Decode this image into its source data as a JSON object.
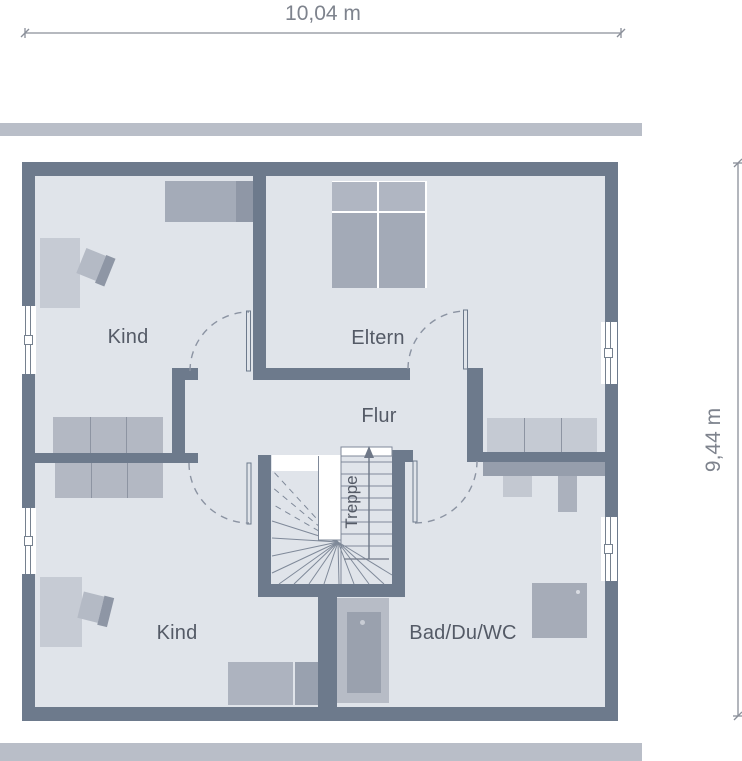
{
  "dimensions": {
    "width_label": "10,04 m",
    "height_label": "9,44 m"
  },
  "rooms": {
    "kind_top": {
      "label": "Kind"
    },
    "eltern": {
      "label": "Eltern"
    },
    "flur": {
      "label": "Flur"
    },
    "kind_bottom": {
      "label": "Kind"
    },
    "bad": {
      "label": "Bad/Du/WC"
    },
    "treppe": {
      "label": "Treppe"
    }
  },
  "colors": {
    "wall": "#6d7a8c",
    "floor": "#e0e4ea",
    "divider_bar": "#b9bec8",
    "room_label_text": "#545a66",
    "dimension_text": "#7e838d",
    "furniture_light": "#c6cbd4",
    "furniture_mid": "#b3b8c3",
    "furniture_dark": "#a3aab7",
    "furniture_darkest": "#8f97a6"
  }
}
